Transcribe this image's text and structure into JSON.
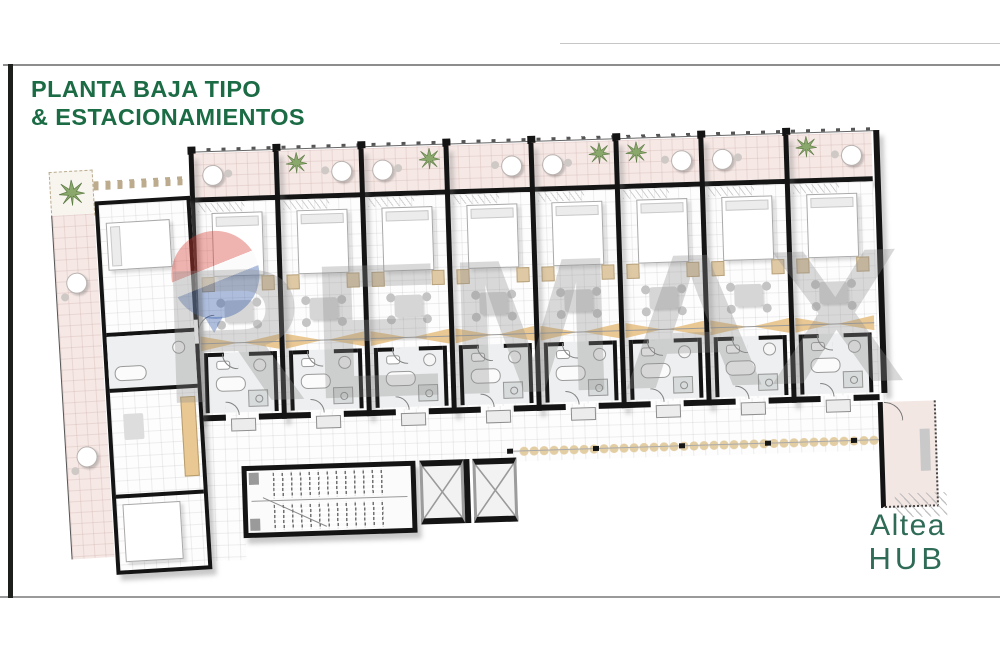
{
  "header": {
    "title_line1": "PLANTA BAJA TIPO",
    "title_line2": "& ESTACIONAMIENTOS"
  },
  "brand": {
    "line1": "Altea",
    "line2": "HUB"
  },
  "watermark": {
    "text": "REMAX"
  },
  "plan": {
    "description": "Ground floor plan with apartment units, balconies, stairs, elevators and parking access",
    "unit_count": 8,
    "units": [
      {
        "plant": false,
        "table": "left"
      },
      {
        "plant": true,
        "table": "right"
      },
      {
        "plant": true,
        "table": "left"
      },
      {
        "plant": false,
        "table": "right"
      },
      {
        "plant": true,
        "table": "left"
      },
      {
        "plant": true,
        "table": "right"
      },
      {
        "plant": false,
        "table": "left"
      },
      {
        "plant": true,
        "table": "right"
      }
    ]
  },
  "colors": {
    "title_green": "#1b6b45",
    "brand_green": "#2f6b57",
    "accent_bar": "#1d1f1d",
    "wall_black": "#141414",
    "balcony_pink": "#f5e8e5",
    "kitchen_tan": "#eac893",
    "hedge_tan": "#e3cda3",
    "watermark_gray": "#8f8f8f",
    "balloon_red": "#d63a30",
    "balloon_blue": "#2c55a5"
  }
}
